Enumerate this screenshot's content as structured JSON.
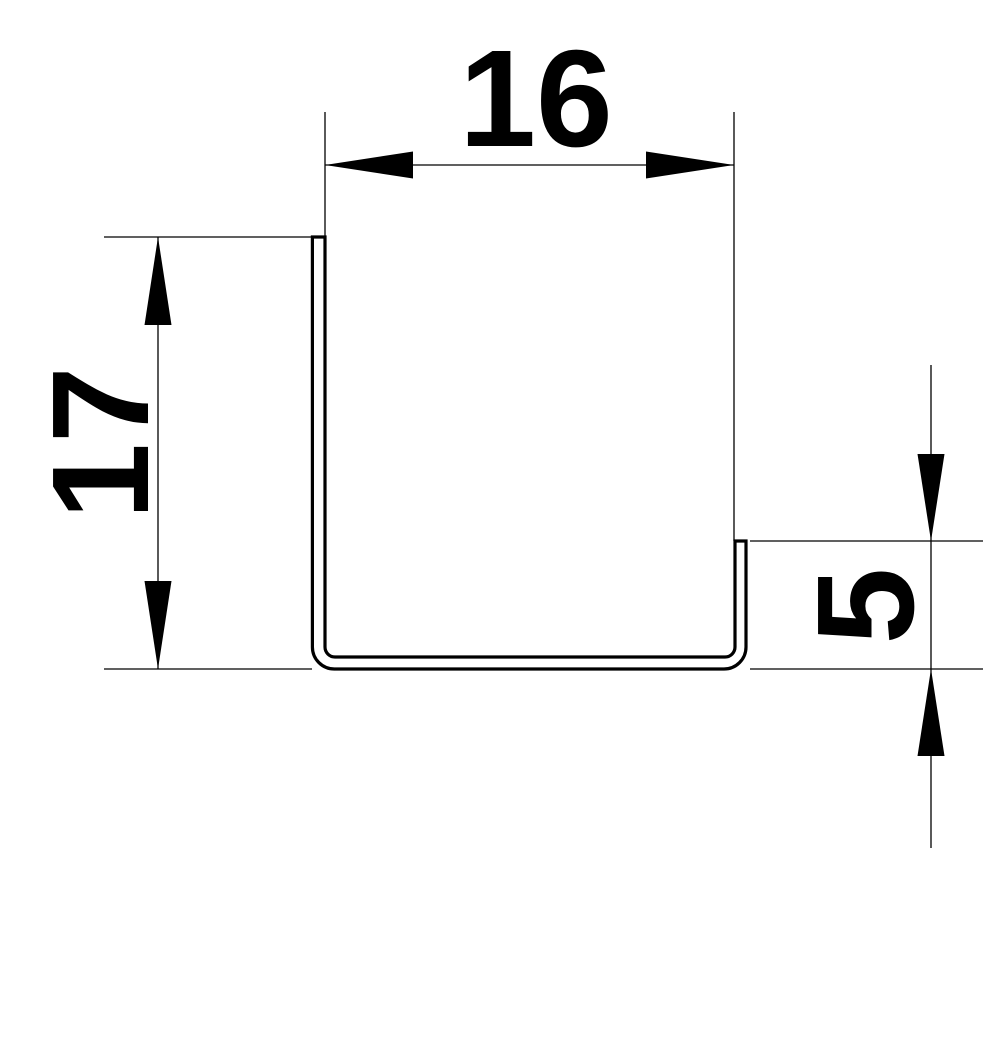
{
  "diagram": {
    "type": "technical-drawing",
    "subject": "sheet-profile-cross-section",
    "colors": {
      "background": "#ffffff",
      "line": "#000000",
      "text": "#000000"
    },
    "dimensions": {
      "width": {
        "label": "16",
        "orientation": "horizontal",
        "position": "top"
      },
      "height": {
        "label": "17",
        "orientation": "vertical",
        "position": "left"
      },
      "flange": {
        "label": "5",
        "orientation": "vertical",
        "position": "right"
      }
    }
  }
}
